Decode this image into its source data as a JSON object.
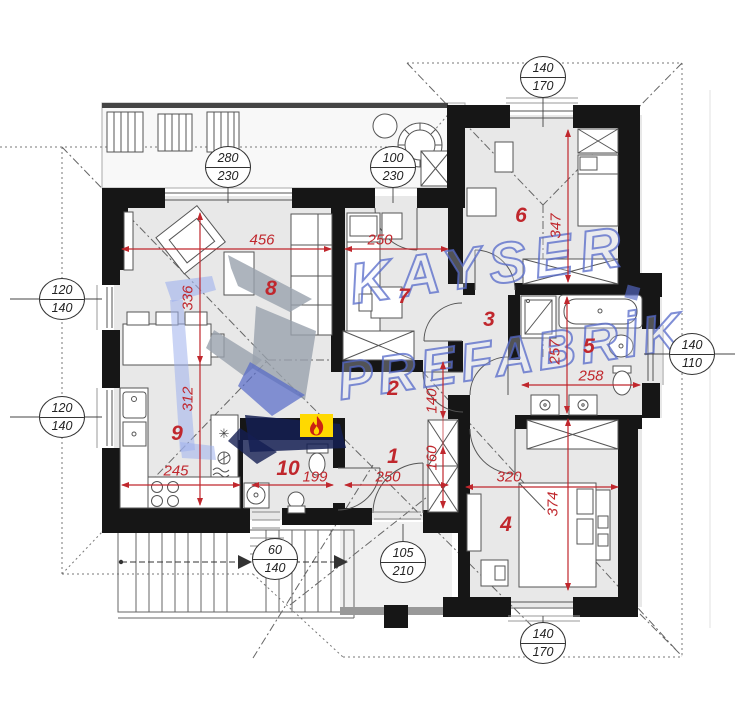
{
  "watermark": {
    "brand_top": "KAYSER",
    "brand_bottom": "PREFABRİK"
  },
  "room_labels": [
    "1",
    "2",
    "3",
    "4",
    "5",
    "6",
    "7",
    "8",
    "9",
    "10"
  ],
  "dimensions": {
    "living_width": "456",
    "bedroom7_width": "250",
    "bedroom6_depth": "347",
    "living_depth": "336",
    "kitchen_depth": "312",
    "kitchen_width": "245",
    "wc_width": "199",
    "hall_width": "250",
    "bedroom4_width": "320",
    "bedroom4_depth": "374",
    "bath_depth": "257",
    "bath_width": "258",
    "corridor_width": "140",
    "entry_width": "160"
  },
  "opening_tags": [
    {
      "width": "280",
      "height": "230"
    },
    {
      "width": "100",
      "height": "230"
    },
    {
      "width": "140",
      "height": "170"
    },
    {
      "width": "120",
      "height": "140"
    },
    {
      "width": "120",
      "height": "140"
    },
    {
      "width": "140",
      "height": "110"
    },
    {
      "width": "60",
      "height": "140"
    },
    {
      "width": "105",
      "height": "210"
    },
    {
      "width": "140",
      "height": "170"
    }
  ],
  "colors": {
    "dimension_red": "#c0272d",
    "wall": "#161616",
    "flame_yellow": "#ffd900",
    "flame_red": "#cc2212",
    "watermark_blue": "#5468c8"
  }
}
